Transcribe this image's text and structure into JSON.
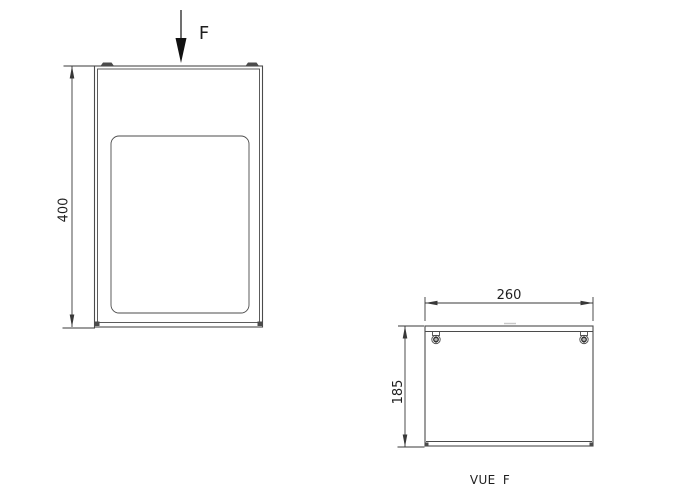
{
  "colors": {
    "background": "#ffffff",
    "line": "#4b4b4b",
    "dim": "#383838",
    "text": "#1e1e1e"
  },
  "front_view": {
    "force_label": "F",
    "height_dim": "400"
  },
  "vue_f": {
    "width_dim": "260",
    "height_dim": "185",
    "caption": "VUE F"
  }
}
